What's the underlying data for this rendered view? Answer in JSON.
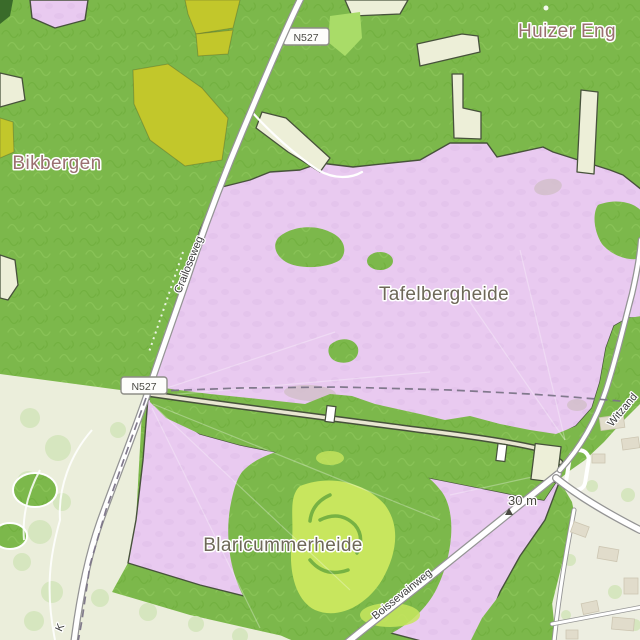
{
  "map": {
    "labels": {
      "place": [
        {
          "text": "Bikbergen"
        },
        {
          "text": "Huizer Eng"
        }
      ],
      "area": [
        {
          "text": "Tafelbergheide"
        },
        {
          "text": "Blaricummerheide"
        }
      ],
      "streets": [
        {
          "text": "Crailoseweg"
        },
        {
          "text": "Boissevainweg"
        },
        {
          "text": "Witzand"
        },
        {
          "text": "K"
        }
      ],
      "badges": [
        {
          "text": "N527"
        },
        {
          "text": "N527"
        }
      ],
      "elevation": {
        "text": "30 m"
      }
    },
    "colors": {
      "forest": "#7cb84b",
      "sq1": "#6cab38",
      "sq2": "#93cb62",
      "heath": "#e9caf0",
      "heathSpot": "#dfbde7",
      "field": "#c2c72b",
      "farm": "#edefd8",
      "park": "#ebeedb",
      "residential": "#edeee1",
      "lime": "#c8e65e",
      "bright": "#a9dc68",
      "curl": "#69a83e",
      "boundary": "#47523b",
      "roadCasing": "#949494",
      "roadFill": "#ffffff",
      "trackFill": "#e9e6d2",
      "adminDash": "#7b7487",
      "halo": "#ffffff",
      "placeLabel": "#9a7070",
      "areaLabel": "#6e6858",
      "streetLabel": "#3d3d3d",
      "badgeBorder": "#8e8e88",
      "badgeText": "#4a4a44",
      "peak": "#4a4a42",
      "treeBlob": "#d6e6bf",
      "building": "#e1dccb",
      "mauvePatch": "#d2bfca",
      "darkCorner": "#3a6b2a"
    }
  }
}
